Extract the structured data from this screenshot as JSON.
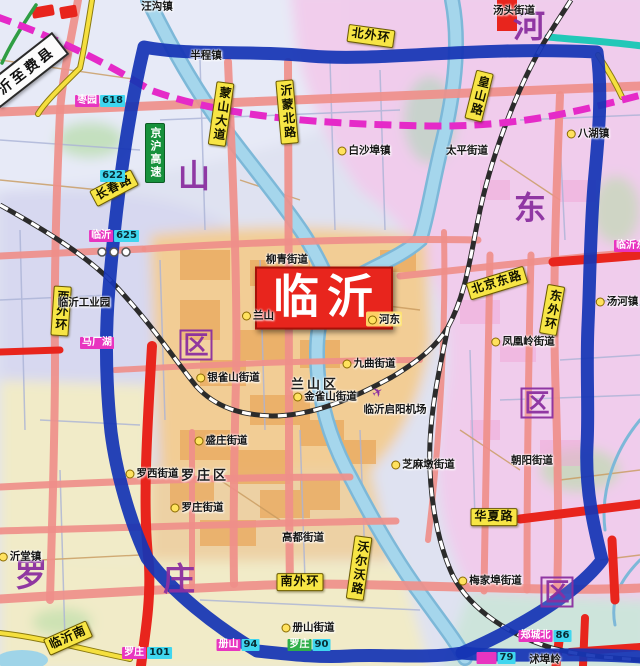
{
  "map": {
    "title": "临沂城区地图",
    "city_box": {
      "text": "临沂"
    },
    "white_banner": {
      "text": "沂至费县",
      "x": 26,
      "y": 70,
      "rot": -38
    },
    "expressway_sign": {
      "text": "京沪高速",
      "x": 155,
      "y": 153
    },
    "city_box_pos": {
      "x": 324,
      "y": 298
    },
    "big_chars": [
      {
        "text": "山",
        "x": 194,
        "y": 176,
        "boxed": false
      },
      {
        "text": "区",
        "x": 196,
        "y": 345,
        "boxed": true
      },
      {
        "text": "河",
        "x": 529,
        "y": 26,
        "boxed": false
      },
      {
        "text": "东",
        "x": 530,
        "y": 208,
        "boxed": false
      },
      {
        "text": "区",
        "x": 537,
        "y": 403,
        "boxed": true
      },
      {
        "text": "罗",
        "x": 31,
        "y": 575,
        "boxed": false
      },
      {
        "text": "庄",
        "x": 179,
        "y": 579,
        "boxed": false
      },
      {
        "text": "区",
        "x": 557,
        "y": 592,
        "boxed": true
      }
    ],
    "road_signs": [
      {
        "text": "北外环",
        "x": 371,
        "y": 36,
        "rot": 8,
        "vertical": false
      },
      {
        "text": "长春路",
        "x": 114,
        "y": 188,
        "rot": -28,
        "vertical": false
      },
      {
        "text": "蒙山大道",
        "x": 221,
        "y": 114,
        "rot": 8,
        "vertical": true
      },
      {
        "text": "沂蒙北路",
        "x": 287,
        "y": 112,
        "rot": -5,
        "vertical": true
      },
      {
        "text": "皇山路",
        "x": 479,
        "y": 96,
        "rot": 14,
        "vertical": true
      },
      {
        "text": "西外环",
        "x": 61,
        "y": 311,
        "rot": 4,
        "vertical": true
      },
      {
        "text": "东外环",
        "x": 552,
        "y": 310,
        "rot": 10,
        "vertical": true
      },
      {
        "text": "北京东路",
        "x": 497,
        "y": 283,
        "rot": -17,
        "vertical": false
      },
      {
        "text": "南外环",
        "x": 300,
        "y": 582,
        "rot": 0,
        "vertical": false
      },
      {
        "text": "华夏路",
        "x": 494,
        "y": 517,
        "rot": 0,
        "vertical": false
      },
      {
        "text": "沃尔沃路",
        "x": 359,
        "y": 568,
        "rot": 8,
        "vertical": true
      },
      {
        "text": "临沂南",
        "x": 68,
        "y": 638,
        "rot": -24,
        "vertical": false
      }
    ],
    "towns": [
      {
        "text": "汪沟镇",
        "x": 157,
        "y": 6
      },
      {
        "text": "半程镇",
        "x": 206,
        "y": 55
      },
      {
        "text": "白沙埠镇",
        "x": 364,
        "y": 150,
        "dot": true
      },
      {
        "text": "太平街道",
        "x": 467,
        "y": 150
      },
      {
        "text": "八湖镇",
        "x": 588,
        "y": 133,
        "dot": true
      },
      {
        "text": "汤头街道",
        "x": 514,
        "y": 10
      },
      {
        "text": "柳青街道",
        "x": 287,
        "y": 259
      },
      {
        "text": "兰山",
        "x": 258,
        "y": 315,
        "dot": true
      },
      {
        "text": "河东",
        "x": 384,
        "y": 319,
        "dot": true,
        "chip": true
      },
      {
        "text": "九曲街道",
        "x": 369,
        "y": 363,
        "dot": true
      },
      {
        "text": "兰山区",
        "x": 315,
        "y": 383,
        "big": true
      },
      {
        "text": "金雀山街道",
        "x": 325,
        "y": 396,
        "dot": true
      },
      {
        "text": "银雀山街道",
        "x": 228,
        "y": 377,
        "dot": true
      },
      {
        "text": "临沂启阳机场",
        "x": 395,
        "y": 409
      },
      {
        "text": "凤凰岭街道",
        "x": 523,
        "y": 341,
        "dot": true
      },
      {
        "text": "汤河镇",
        "x": 617,
        "y": 301,
        "dot": true
      },
      {
        "text": "盛庄街道",
        "x": 221,
        "y": 440,
        "dot": true
      },
      {
        "text": "罗西街道",
        "x": 152,
        "y": 473,
        "dot": true
      },
      {
        "text": "罗庄区",
        "x": 205,
        "y": 474,
        "big": true
      },
      {
        "text": "罗庄街道",
        "x": 197,
        "y": 507,
        "dot": true
      },
      {
        "text": "高都街道",
        "x": 303,
        "y": 537
      },
      {
        "text": "沂堂镇",
        "x": 20,
        "y": 556,
        "dot": true
      },
      {
        "text": "芝麻墩街道",
        "x": 423,
        "y": 464,
        "dot": true
      },
      {
        "text": "朝阳街道",
        "x": 532,
        "y": 460
      },
      {
        "text": "梅家埠街道",
        "x": 490,
        "y": 580,
        "dot": true
      },
      {
        "text": "册山街道",
        "x": 308,
        "y": 627,
        "dot": true
      },
      {
        "text": "沭埠岭",
        "x": 545,
        "y": 659
      },
      {
        "text": "临沂工业园",
        "x": 84,
        "y": 302
      }
    ],
    "markers": [
      {
        "text": "枣园",
        "num": "618",
        "x": 100,
        "y": 101,
        "bg": "magenta"
      },
      {
        "text": "临沂",
        "num": "625",
        "x": 114,
        "y": 236,
        "bg": "magenta"
      },
      {
        "text": "马厂湖",
        "num": "",
        "x": 97,
        "y": 343,
        "bg": "magenta"
      },
      {
        "text": "临沂东",
        "num": "",
        "x": 631,
        "y": 246,
        "bg": "magenta"
      },
      {
        "text": "郑城北",
        "num": "86",
        "x": 545,
        "y": 636,
        "bg": "magenta"
      },
      {
        "text": "册山",
        "num": "94",
        "x": 238,
        "y": 645,
        "bg": "magenta"
      },
      {
        "text": "罗庄",
        "num": "90",
        "x": 309,
        "y": 645,
        "bg": "green"
      },
      {
        "text": "罗庄",
        "num": "101",
        "x": 147,
        "y": 653,
        "bg": "magenta"
      },
      {
        "text": "",
        "num": "79",
        "x": 496,
        "y": 658,
        "bg": "magenta"
      },
      {
        "text": "",
        "num": "622",
        "x": 112,
        "y": 176,
        "bg": "none"
      }
    ],
    "airport_icon": {
      "glyph": "✈",
      "x": 378,
      "y": 393
    },
    "colors": {
      "ring_blue": "#1535b5",
      "road_salmon": "#ef8f8a",
      "road_red": "#e8251d",
      "hsr_magenta": "#e52ac8",
      "teal": "#22c8b8",
      "sign_yellow": "#f7e545",
      "river": "#a5d6ec",
      "district_purple": "#8b2fa0",
      "city_red": "#e8251d"
    }
  }
}
